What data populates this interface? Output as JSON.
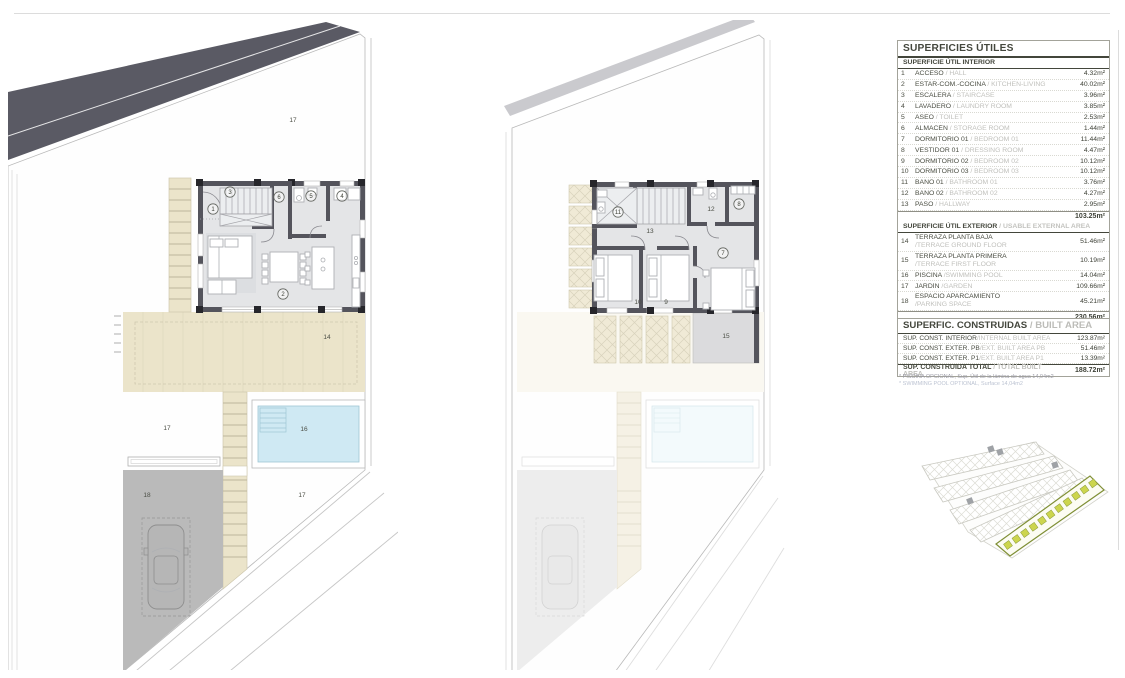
{
  "usable_table": {
    "title": "SUPERFICIES ÚTILES",
    "interior_header": "SUPERFICIE ÚTIL INTERIOR",
    "interior_rows": [
      {
        "num": "1",
        "name": "ACCESO",
        "en": " / HALL",
        "value": "4.32m²"
      },
      {
        "num": "2",
        "name": "ESTAR-COM.-COCINA",
        "en": " / KITCHEN-LIVING",
        "value": "40.02m²"
      },
      {
        "num": "3",
        "name": "ESCALERA",
        "en": " / STAIRCASE",
        "value": "3.96m²"
      },
      {
        "num": "4",
        "name": "LAVADERO",
        "en": " / LAUNDRY ROOM",
        "value": "3.85m²"
      },
      {
        "num": "5",
        "name": "ASEO",
        "en": " / TOILET",
        "value": "2.53m²"
      },
      {
        "num": "6",
        "name": "ALMACÉN",
        "en": " / STORAGE ROOM",
        "value": "1.44m²"
      },
      {
        "num": "7",
        "name": "DORMITORIO 01",
        "en": " / BEDROOM 01",
        "value": "11.44m²"
      },
      {
        "num": "8",
        "name": "VESTIDOR 01",
        "en": " / DRESSING ROOM",
        "value": "4.47m²"
      },
      {
        "num": "9",
        "name": "DORMITORIO 02",
        "en": " / BEDROOM 02",
        "value": "10.12m²"
      },
      {
        "num": "10",
        "name": "DORMITORIO 03",
        "en": " / BEDROOM 03",
        "value": "10.12m²"
      },
      {
        "num": "11",
        "name": "BAÑO 01",
        "en": " / BATHROOM 01",
        "value": "3.76m²"
      },
      {
        "num": "12",
        "name": "BAÑO 02",
        "en": " / BATHROOM 02",
        "value": "4.27m²"
      },
      {
        "num": "13",
        "name": "PASO",
        "en": " / HALLWAY",
        "value": "2.95m²"
      }
    ],
    "interior_subtotal": "103.25m²",
    "exterior_header": "SUPERFICIE ÚTIL EXTERIOR",
    "exterior_header_en": " / USABLE EXTERNAL AREA",
    "exterior_rows": [
      {
        "num": "14",
        "name": "TERRAZA PLANTA BAJA",
        "en": "/TERRACE GROUND FLOOR",
        "value": "51.46m²",
        "two_line": true
      },
      {
        "num": "15",
        "name": "TERRAZA PLANTA PRIMERA",
        "en": "/TERRACE FIRST FLOOR",
        "value": "10.19m²",
        "two_line": true
      },
      {
        "num": "16",
        "name": "PISCINA",
        "en": " /SWIMMING POOL",
        "value": "14.04m²",
        "two_line": false
      },
      {
        "num": "17",
        "name": "JARDÍN",
        "en": " /GARDEN",
        "value": "109.66m²",
        "two_line": false
      },
      {
        "num": "18",
        "name": "ESPACIO APARCAMIENTO",
        "en": "/PARKING SPACE",
        "value": "45.21m²",
        "two_line": true
      }
    ],
    "exterior_subtotal": "230.56m²",
    "total_label": "SUPERFICIE ÚTIL TOTAL",
    "total_label_en": " / TOTAL USABLE AREA",
    "total_value": "333.81m²"
  },
  "built_table": {
    "title": "SUPERFIC. CONSTRUIDAS",
    "title_en": " / BUILT AREA",
    "rows": [
      {
        "name": "SUP. CONST. INTERIOR",
        "en": "/INTERNAL BUILT AREA",
        "value": "123.87m²"
      },
      {
        "name": "SUP. CONST. EXTER. PB",
        "en": "/EXT. BUILT AREA PB",
        "value": "51.46m²"
      },
      {
        "name": "SUP. CONST. EXTER. P1",
        "en": "/EXT. BUILT AREA P1",
        "value": "13.39m²"
      }
    ],
    "total_label": "SUP. CONSTRUIDA TOTAL",
    "total_label_en": " / TOTAL BUILT AREA",
    "total_value": "188.72m²",
    "footnotes": [
      "* PISCINA OPCIONAL, Sup. Útil de la lámina de agua 14,04m2",
      "* SWIMMING POOL OPTIONAL, Surface 14,04m2"
    ]
  },
  "plans": {
    "ground": {
      "labels": {
        "acceso": "1",
        "estar": "2",
        "escalera": "3",
        "lavadero": "4",
        "aseo": "5",
        "almacen": "6",
        "terraza_pb": "14",
        "piscina": "16",
        "jardin_top": "17",
        "jardin_mid": "17",
        "jardin_bottom": "17",
        "parking": "18"
      }
    },
    "first": {
      "labels": {
        "dorm01": "7",
        "vestidor": "8",
        "dorm02": "9",
        "dorm03": "10",
        "bano01": "11",
        "bano02": "12",
        "paso": "13",
        "terraza_p1": "15"
      }
    }
  },
  "colors": {
    "road_dark": "#5a5a64",
    "road_light": "#cacace",
    "wall": "#54545c",
    "floor": "#e4e5e7",
    "terrace_beige": "#ebe4ca",
    "pool_water": "#cfe9f3",
    "parking_gray": "#bababa",
    "terrace_p1_gray": "#dbdbdd",
    "plot_highlight_fill": "#ccd54e",
    "plot_highlight_stroke": "#7f8f35",
    "text_dark": "#44473d",
    "text_gray": "#c0c0bc"
  }
}
